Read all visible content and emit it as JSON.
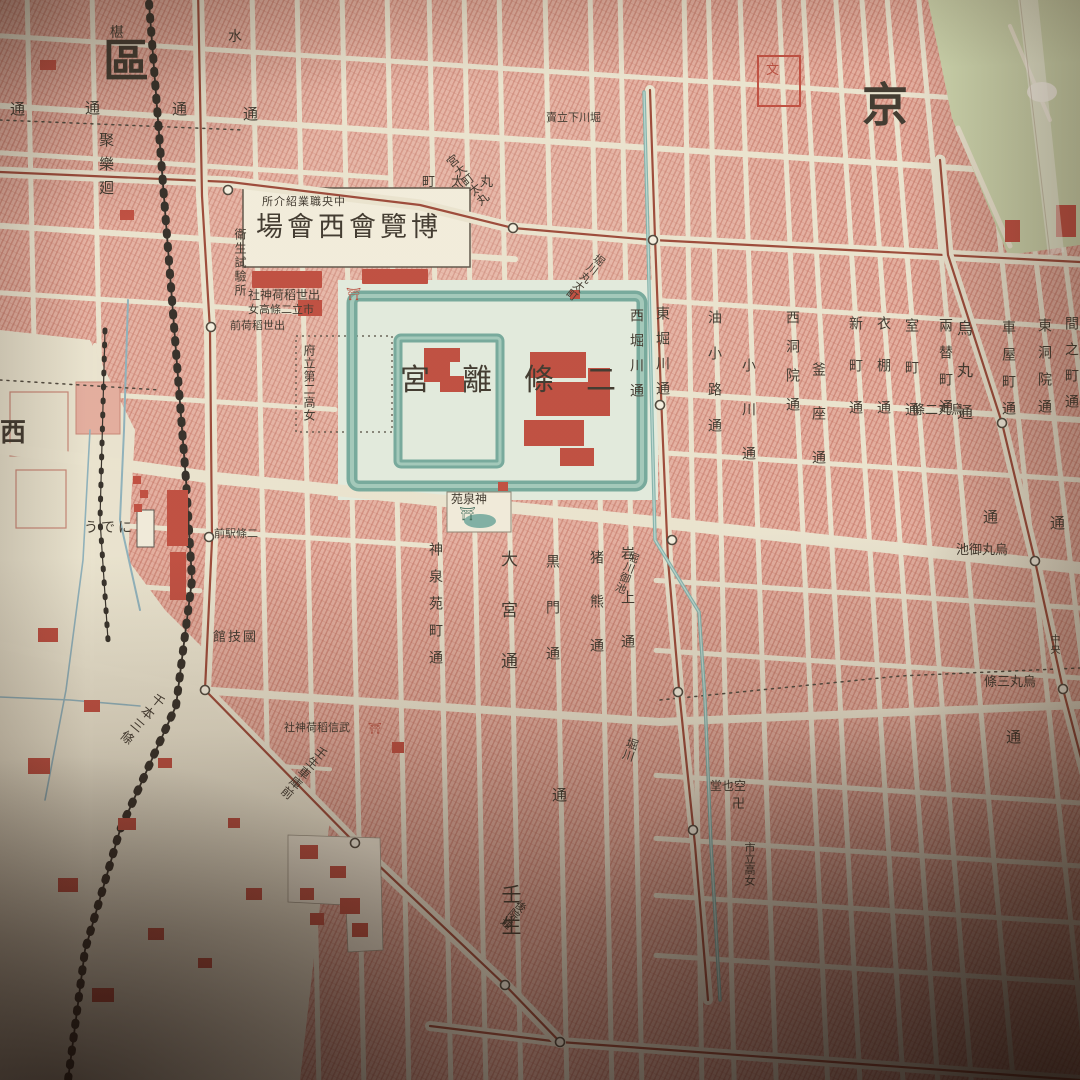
{
  "map_type": "vintage Japanese city map photograph (Kyoto, Nijo Castle area)",
  "colors": {
    "paper": "#eae5d0",
    "paper_light": "#e9e4cf",
    "block": "#e5ac9d",
    "moat": "#6fa99c",
    "moat_light": "#9fc9bb",
    "canal": "#7fb3ad",
    "stream": "#8ab0bd",
    "tram": "#9c4434",
    "rail": "#2e2a24",
    "park": "#ccd6ad",
    "building": "#c2493b",
    "text": "#3a342b",
    "stop_fill": "#f4f0e0",
    "stop_ring": "#4a443a",
    "castle_ground": "#e2ecdf",
    "white_box": "#f2eedd"
  },
  "labels": [
    {
      "text": "區",
      "x": 103,
      "y": 38,
      "s": 46,
      "b": 1
    },
    {
      "text": "京",
      "x": 862,
      "y": 82,
      "s": 46,
      "b": 1
    },
    {
      "text": "西",
      "x": 0,
      "y": 420,
      "s": 26,
      "b": 1
    },
    {
      "text": "宮離條二",
      "x": 400,
      "y": 366,
      "s": 30,
      "ls": 32
    },
    {
      "text": "場會西會覽博",
      "x": 256,
      "y": 214,
      "s": 27,
      "ls": 4
    },
    {
      "text": "所介紹業職央中",
      "x": 262,
      "y": 196,
      "s": 11,
      "ls": 1
    },
    {
      "text": "衛生試驗所",
      "x": 234,
      "y": 228,
      "s": 12,
      "v": 1,
      "ls": 2
    },
    {
      "text": "社神荷稻世出",
      "x": 248,
      "y": 289,
      "s": 12
    },
    {
      "text": "⛩",
      "x": 346,
      "y": 288,
      "s": 12,
      "c": "#b9483a"
    },
    {
      "text": "女高條二立市",
      "x": 248,
      "y": 304,
      "s": 11
    },
    {
      "text": "前荷稻世出",
      "x": 230,
      "y": 320,
      "s": 11
    },
    {
      "text": "府立第二高女",
      "x": 303,
      "y": 344,
      "s": 12,
      "v": 1,
      "ls": 1
    },
    {
      "text": "苑泉神",
      "x": 451,
      "y": 493,
      "s": 12
    },
    {
      "text": "⛩",
      "x": 459,
      "y": 508,
      "s": 13,
      "c": "#3f6f60"
    },
    {
      "text": "うでに",
      "x": 84,
      "y": 521,
      "s": 14,
      "ls": 3
    },
    {
      "text": "前駅條二",
      "x": 214,
      "y": 528,
      "s": 11
    },
    {
      "text": "館技國",
      "x": 213,
      "y": 631,
      "s": 13,
      "ls": 2
    },
    {
      "text": "聚樂廻",
      "x": 98,
      "y": 132,
      "s": 15,
      "v": 1,
      "ls": 9
    },
    {
      "text": "神泉苑町通",
      "x": 428,
      "y": 542,
      "s": 14,
      "v": 1,
      "ls": 13
    },
    {
      "text": "大宮通",
      "x": 498,
      "y": 550,
      "s": 17,
      "v": 1,
      "ls": 34
    },
    {
      "text": "黒門通",
      "x": 545,
      "y": 554,
      "s": 14,
      "v": 1,
      "ls": 32
    },
    {
      "text": "猪熊通",
      "x": 589,
      "y": 550,
      "s": 14,
      "v": 1,
      "ls": 30
    },
    {
      "text": "岩上通",
      "x": 620,
      "y": 546,
      "s": 14,
      "v": 1,
      "ls": 30
    },
    {
      "text": "西堀川通",
      "x": 629,
      "y": 308,
      "s": 14,
      "v": 1,
      "ls": 11
    },
    {
      "text": "東堀川通",
      "x": 655,
      "y": 306,
      "s": 14,
      "v": 1,
      "ls": 11
    },
    {
      "text": "油小路通",
      "x": 707,
      "y": 310,
      "s": 14,
      "v": 1,
      "ls": 22
    },
    {
      "text": "小川通",
      "x": 741,
      "y": 358,
      "s": 14,
      "v": 1,
      "ls": 30
    },
    {
      "text": "西洞院通",
      "x": 785,
      "y": 310,
      "s": 14,
      "v": 1,
      "ls": 15
    },
    {
      "text": "釜座通",
      "x": 811,
      "y": 362,
      "s": 14,
      "v": 1,
      "ls": 30
    },
    {
      "text": "新町通",
      "x": 848,
      "y": 316,
      "s": 14,
      "v": 1,
      "ls": 28
    },
    {
      "text": "衣棚通",
      "x": 876,
      "y": 316,
      "s": 14,
      "v": 1,
      "ls": 28
    },
    {
      "text": "室町通",
      "x": 904,
      "y": 318,
      "s": 14,
      "v": 1,
      "ls": 28
    },
    {
      "text": "兩替町通",
      "x": 938,
      "y": 318,
      "s": 14,
      "v": 1,
      "ls": 13
    },
    {
      "text": "烏丸通",
      "x": 955,
      "y": 320,
      "s": 16,
      "v": 1,
      "ls": 26
    },
    {
      "text": "車屋町通",
      "x": 1001,
      "y": 320,
      "s": 14,
      "v": 1,
      "ls": 13
    },
    {
      "text": "東洞院通",
      "x": 1037,
      "y": 318,
      "s": 14,
      "v": 1,
      "ls": 13
    },
    {
      "text": "間之町通",
      "x": 1064,
      "y": 316,
      "s": 14,
      "v": 1,
      "ls": 12
    },
    {
      "text": "通",
      "x": 10,
      "y": 102,
      "s": 15
    },
    {
      "text": "通",
      "x": 85,
      "y": 101,
      "s": 15
    },
    {
      "text": "通",
      "x": 172,
      "y": 102,
      "s": 15
    },
    {
      "text": "通",
      "x": 243,
      "y": 107,
      "s": 15
    },
    {
      "text": "通",
      "x": 983,
      "y": 510,
      "s": 15
    },
    {
      "text": "通",
      "x": 1050,
      "y": 516,
      "s": 15
    },
    {
      "text": "通",
      "x": 1006,
      "y": 730,
      "s": 15
    },
    {
      "text": "通",
      "x": 552,
      "y": 788,
      "s": 15
    },
    {
      "text": "條二丸烏",
      "x": 912,
      "y": 404,
      "s": 13
    },
    {
      "text": "池御丸烏",
      "x": 956,
      "y": 544,
      "s": 13
    },
    {
      "text": "條三丸烏",
      "x": 984,
      "y": 676,
      "s": 13
    },
    {
      "text": "賣立下川堀",
      "x": 546,
      "y": 112,
      "s": 11
    },
    {
      "text": "堀川御池",
      "x": 630,
      "y": 550,
      "s": 11,
      "v": 1,
      "rot": 22
    },
    {
      "text": "堀川",
      "x": 628,
      "y": 736,
      "s": 12,
      "v": 1,
      "rot": 18
    },
    {
      "text": "千本三條",
      "x": 156,
      "y": 690,
      "s": 13,
      "v": 1,
      "rot": 40,
      "ls": 3
    },
    {
      "text": "壬生車庫前",
      "x": 320,
      "y": 744,
      "s": 12,
      "v": 1,
      "rot": 40,
      "ls": 1
    },
    {
      "text": "社神荷稻信武",
      "x": 284,
      "y": 722,
      "s": 11
    },
    {
      "text": "⛩",
      "x": 368,
      "y": 723,
      "s": 11,
      "c": "#b9483a"
    },
    {
      "text": "堂也空",
      "x": 710,
      "y": 780,
      "s": 12
    },
    {
      "text": "卍",
      "x": 732,
      "y": 798,
      "s": 13
    },
    {
      "text": "市立高女",
      "x": 744,
      "y": 842,
      "s": 11,
      "v": 1
    },
    {
      "text": "壬生",
      "x": 500,
      "y": 884,
      "s": 20,
      "v": 1,
      "ls": 11
    },
    {
      "text": "町太丸",
      "x": 422,
      "y": 176,
      "s": 13,
      "ls": 16
    },
    {
      "text": "宮大町太丸",
      "x": 444,
      "y": 160,
      "s": 12,
      "v": 1,
      "rot": -38
    },
    {
      "text": "堀川丸太町",
      "x": 598,
      "y": 252,
      "s": 11,
      "v": 1,
      "rot": 38
    },
    {
      "text": "後院通",
      "x": 520,
      "y": 898,
      "s": 11,
      "v": 1,
      "rot": 40
    },
    {
      "text": "中央",
      "x": 1048,
      "y": 634,
      "s": 10,
      "v": 1
    },
    {
      "text": "椹",
      "x": 110,
      "y": 26,
      "s": 14
    },
    {
      "text": "水",
      "x": 228,
      "y": 30,
      "s": 14
    },
    {
      "text": "文",
      "x": 766,
      "y": 64,
      "s": 13,
      "c": "#b9483a"
    }
  ],
  "tram_stops": [
    [
      228,
      190
    ],
    [
      513,
      228
    ],
    [
      653,
      240
    ],
    [
      211,
      327
    ],
    [
      209,
      537
    ],
    [
      205,
      690
    ],
    [
      355,
      843
    ],
    [
      660,
      405
    ],
    [
      672,
      540
    ],
    [
      678,
      692
    ],
    [
      693,
      830
    ],
    [
      1002,
      423
    ],
    [
      1035,
      561
    ],
    [
      1063,
      689
    ],
    [
      560,
      1042
    ],
    [
      505,
      985
    ]
  ]
}
